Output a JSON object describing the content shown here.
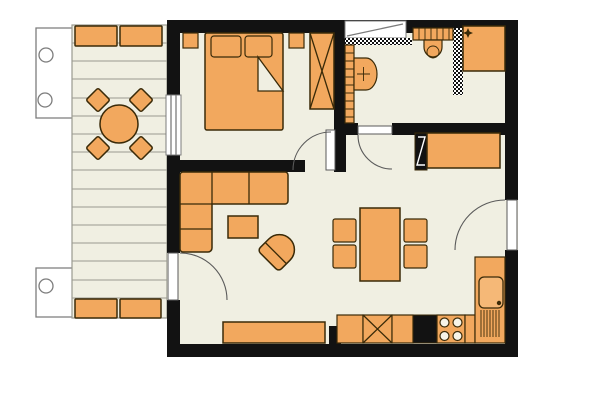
{
  "meta": {
    "kind": "apartment-floor-plan",
    "description": "Top-down architectural floor plan of a one-bedroom apartment with terrace; no text labels visible"
  },
  "colors": {
    "background": "#ffffff",
    "wall": "#121212",
    "floor": "#f0efe2",
    "furniture_fill": "#f2a85e",
    "furniture_line": "#3a2a08",
    "deck_line": "#9a9a90",
    "outline_gray": "#7c7c7c",
    "door_arc": "#5a5a5a"
  },
  "rooms": [
    {
      "name": "terrace"
    },
    {
      "name": "bedroom"
    },
    {
      "name": "bathroom"
    },
    {
      "name": "hall"
    },
    {
      "name": "living-dining-room"
    },
    {
      "name": "kitchen"
    }
  ],
  "inventory": {
    "terrace": [
      "planter",
      "planter",
      "round-table",
      "chair",
      "chair",
      "chair",
      "chair",
      "planter",
      "planter"
    ],
    "bedroom": [
      "double-bed",
      "pillow",
      "pillow",
      "wall-shelf",
      "wall-shelf",
      "wardrobe"
    ],
    "bathroom": [
      "towel-radiator",
      "washbasin",
      "toilet",
      "shower",
      "tiled-partition"
    ],
    "hall": [
      "wardrobe",
      "mirror-panel"
    ],
    "living_dining": [
      "corner-sofa",
      "coffee-table",
      "armchair",
      "sideboard",
      "dining-table",
      "chair",
      "chair",
      "chair",
      "chair"
    ],
    "kitchen": [
      "counter",
      "dishwasher",
      "counter",
      "oven",
      "stove",
      "sink",
      "drainer"
    ]
  }
}
